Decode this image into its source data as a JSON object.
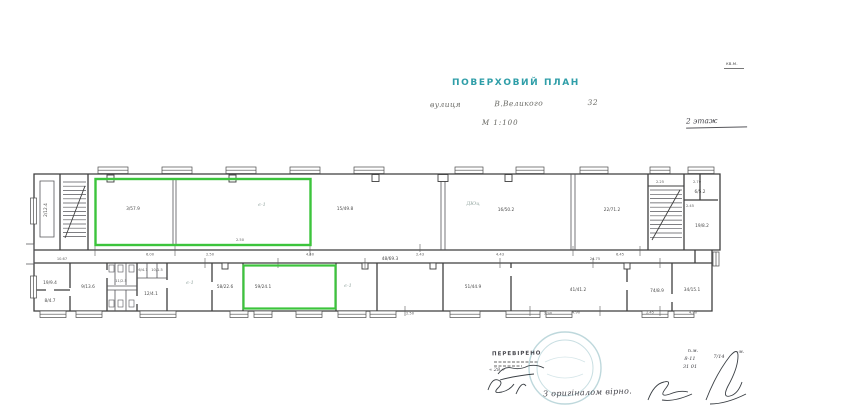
{
  "document": {
    "title": "ПОВЕРХОВИЙ ПЛАН",
    "address_line": "вулиця            В.Великого                32",
    "scale": "М 1:100",
    "top_right_note": "кв.м.",
    "floor_note": "2 этаж"
  },
  "stamps": {
    "reviewed": "ПЕРЕВІРЕНО",
    "certified": "З оригіналом вірно."
  },
  "colors": {
    "highlight_green": "#3cc43c",
    "title_teal": "#2f9ea8",
    "stamp_teal": "#6fa9b2",
    "ink": "#3f3f3f"
  },
  "plan": {
    "labels": [
      {
        "x": 47,
        "y": 210,
        "t": "2/12.4",
        "c": "room",
        "r": -90
      },
      {
        "x": 133,
        "y": 210,
        "t": "3/57.9",
        "c": "room"
      },
      {
        "x": 240,
        "y": 241,
        "t": "2.50",
        "c": "dim"
      },
      {
        "x": 262,
        "y": 206,
        "t": "є-1",
        "c": "pencil"
      },
      {
        "x": 345,
        "y": 210,
        "t": "15/49.8",
        "c": "room"
      },
      {
        "x": 473,
        "y": 205,
        "t": "ДЮц",
        "c": "pencil"
      },
      {
        "x": 506,
        "y": 211,
        "t": "16/50.2",
        "c": "room"
      },
      {
        "x": 612,
        "y": 211,
        "t": "22/71.2",
        "c": "room"
      },
      {
        "x": 660,
        "y": 183,
        "t": "2.25",
        "c": "dim"
      },
      {
        "x": 697,
        "y": 183,
        "t": "2.70",
        "c": "dim"
      },
      {
        "x": 700,
        "y": 193,
        "t": "6/5.2",
        "c": "room"
      },
      {
        "x": 690,
        "y": 207,
        "t": "2.45",
        "c": "dim"
      },
      {
        "x": 702,
        "y": 227,
        "t": "19/8.2",
        "c": "room"
      },
      {
        "x": 150,
        "y": 255.5,
        "t": "6.00",
        "c": "dim"
      },
      {
        "x": 210,
        "y": 255.5,
        "t": "2.50",
        "c": "dim"
      },
      {
        "x": 310,
        "y": 255.5,
        "t": "4.40",
        "c": "dim"
      },
      {
        "x": 420,
        "y": 255.5,
        "t": "2.43",
        "c": "dim"
      },
      {
        "x": 500,
        "y": 255.5,
        "t": "4.43",
        "c": "dim"
      },
      {
        "x": 620,
        "y": 255.5,
        "t": "6.45",
        "c": "dim"
      },
      {
        "x": 62,
        "y": 260,
        "t": "10.67",
        "c": "dim"
      },
      {
        "x": 390,
        "y": 260,
        "t": "48/69.3",
        "c": "room"
      },
      {
        "x": 595,
        "y": 260,
        "t": "24.75",
        "c": "dim"
      },
      {
        "x": 50,
        "y": 284,
        "t": "19/9.4",
        "c": "room"
      },
      {
        "x": 50,
        "y": 302,
        "t": "8/4.7",
        "c": "room"
      },
      {
        "x": 88,
        "y": 288,
        "t": "9/13.6",
        "c": "room"
      },
      {
        "x": 121,
        "y": 282,
        "t": "11/2.5",
        "c": "dim"
      },
      {
        "x": 143,
        "y": 271,
        "t": "6/4.1",
        "c": "dim"
      },
      {
        "x": 157,
        "y": 271,
        "t": "10/1.5",
        "c": "dim"
      },
      {
        "x": 151,
        "y": 295,
        "t": "12/4.1",
        "c": "room"
      },
      {
        "x": 190,
        "y": 284,
        "t": "є-1",
        "c": "pencil"
      },
      {
        "x": 225,
        "y": 288,
        "t": "58/22.6",
        "c": "room"
      },
      {
        "x": 263,
        "y": 288,
        "t": "59/24.1",
        "c": "room"
      },
      {
        "x": 348,
        "y": 287,
        "t": "є-1",
        "c": "pencil"
      },
      {
        "x": 473,
        "y": 288,
        "t": "51/44.9",
        "c": "room"
      },
      {
        "x": 578,
        "y": 291,
        "t": "41/41.2",
        "c": "room"
      },
      {
        "x": 657,
        "y": 292,
        "t": "74/8.9",
        "c": "room"
      },
      {
        "x": 692,
        "y": 291,
        "t": "34/15.1",
        "c": "room"
      },
      {
        "x": 410,
        "y": 314.5,
        "t": "2.50",
        "c": "dim"
      },
      {
        "x": 548,
        "y": 314.5,
        "t": "2.90",
        "c": "dim"
      },
      {
        "x": 576,
        "y": 313.5,
        "t": "4.90",
        "c": "dim"
      },
      {
        "x": 650,
        "y": 313.5,
        "t": "2.45",
        "c": "dim"
      },
      {
        "x": 693,
        "y": 313.5,
        "t": "4.90",
        "c": "dim"
      },
      {
        "x": 693,
        "y": 352,
        "t": "п.м.",
        "c": "hand"
      },
      {
        "x": 690,
        "y": 360,
        "t": "8-11",
        "c": "hand"
      },
      {
        "x": 690,
        "y": 368,
        "t": "31 01",
        "c": "hand"
      },
      {
        "x": 719,
        "y": 358,
        "t": "7/14",
        "c": "hand"
      },
      {
        "x": 739,
        "y": 353,
        "t": "—м.",
        "c": "hand"
      },
      {
        "x": 497,
        "y": 371,
        "t": "« 28 »",
        "c": "hand"
      }
    ]
  }
}
